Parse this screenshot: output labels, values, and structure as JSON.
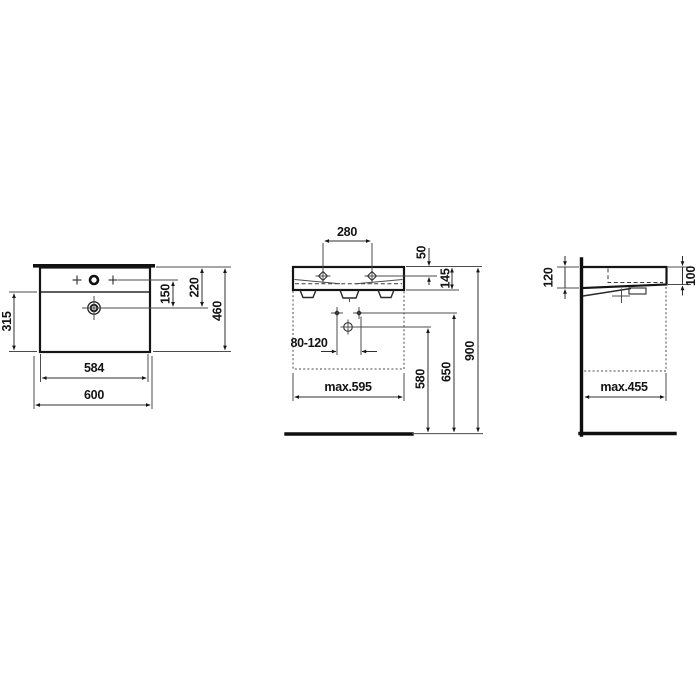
{
  "drawing": {
    "type": "technical-dimension-drawing",
    "background": "#ffffff",
    "outline_color": "#151515",
    "dimension_line_color": "#2f2f2f",
    "text_color": "#141414",
    "views": {
      "top_view": {
        "dims": {
          "tap_to_drain": "150",
          "rim_to_drain": "220",
          "overall_depth": "460",
          "drain_to_front": "315",
          "inner_width": "584",
          "overall_width": "600"
        }
      },
      "front_view": {
        "dims": {
          "fixing_hole_spacing": "280",
          "rim_to_fixing_hole": "50",
          "ceramic_height": "145",
          "bolt_spacing": "80-120",
          "clearance_width": "max.595",
          "floor_to_drain": "580",
          "floor_to_bolts": "650",
          "floor_to_rim": "900"
        }
      },
      "side_view": {
        "dims": {
          "height_at_wall": "120",
          "height_at_front": "100",
          "clearance_depth": "max.455"
        }
      }
    }
  }
}
